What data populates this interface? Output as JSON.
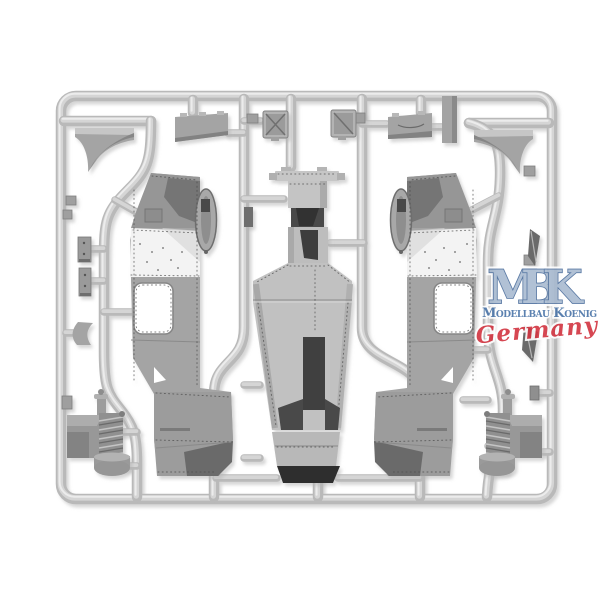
{
  "photo": {
    "subject": "Injection-molded plastic model kit sprue with armored car hull parts on white background",
    "plastic": "light grey styrene"
  },
  "colors": {
    "bg": "#ffffff",
    "plastic-base": "#b9b9b9",
    "plastic-mid": "#d5d5d5",
    "plastic-hi": "#ececec",
    "part": "#a4a4a4",
    "part-light": "#c6c6c6",
    "part-dark": "#7b7b7b",
    "recess": "#3d3d3d",
    "band": "#f3f3f3",
    "rivet": "#4a4a4a",
    "wm-fill": "#a9bbd1",
    "wm-outline": "#4b6d9c",
    "wm-blue": "#4a74a8",
    "wm-red": "#d23440"
  },
  "sprue": {
    "parts": [
      {
        "name": "hull-side-panel-left"
      },
      {
        "name": "hull-side-panel-right"
      },
      {
        "name": "hull-center-section"
      },
      {
        "name": "mudguard-triangle-left"
      },
      {
        "name": "mudguard-triangle-right"
      },
      {
        "name": "stowage-panel-left"
      },
      {
        "name": "stowage-panel-right"
      },
      {
        "name": "roof-hatch-crossed"
      },
      {
        "name": "roof-hatch-diagonal"
      },
      {
        "name": "engine-assembly-left"
      },
      {
        "name": "engine-assembly-right"
      },
      {
        "name": "vision-plate-upper"
      },
      {
        "name": "vision-plate-lower"
      },
      {
        "name": "blade-part-upper"
      },
      {
        "name": "blade-part-lower"
      },
      {
        "name": "bracket-hook"
      },
      {
        "name": "mounting-ring"
      },
      {
        "name": "filler-block"
      }
    ]
  },
  "watermark": {
    "initials": "MBK",
    "company": "Modellbau Koenig",
    "country": "Germany"
  }
}
